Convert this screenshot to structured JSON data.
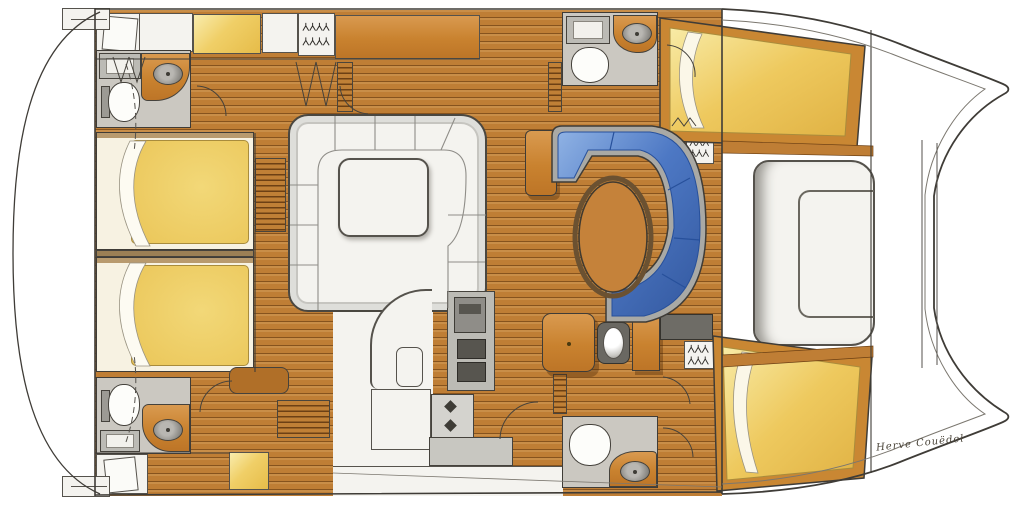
{
  "signature": {
    "text": "Herve Couëdel"
  },
  "icons": {
    "hanger": "clothes-hanger-icon",
    "burner": "stove-burner-icon"
  },
  "palette": {
    "line": "#3f3c37",
    "wood": "#bf7e35",
    "wood_line": "#58300a",
    "counter_orange": "#c9822f",
    "bed_yellow": "#ecc95e",
    "bed_frame": "#c98733",
    "sofa_blue": "#4d78c4",
    "sofa_blue_dark": "#2a4f97",
    "upholstery_white": "#f4f3ef",
    "appliance_gray": "#bcbbb5",
    "bath_floor": "#cbc8c1",
    "hull_white": "#ffffff"
  }
}
